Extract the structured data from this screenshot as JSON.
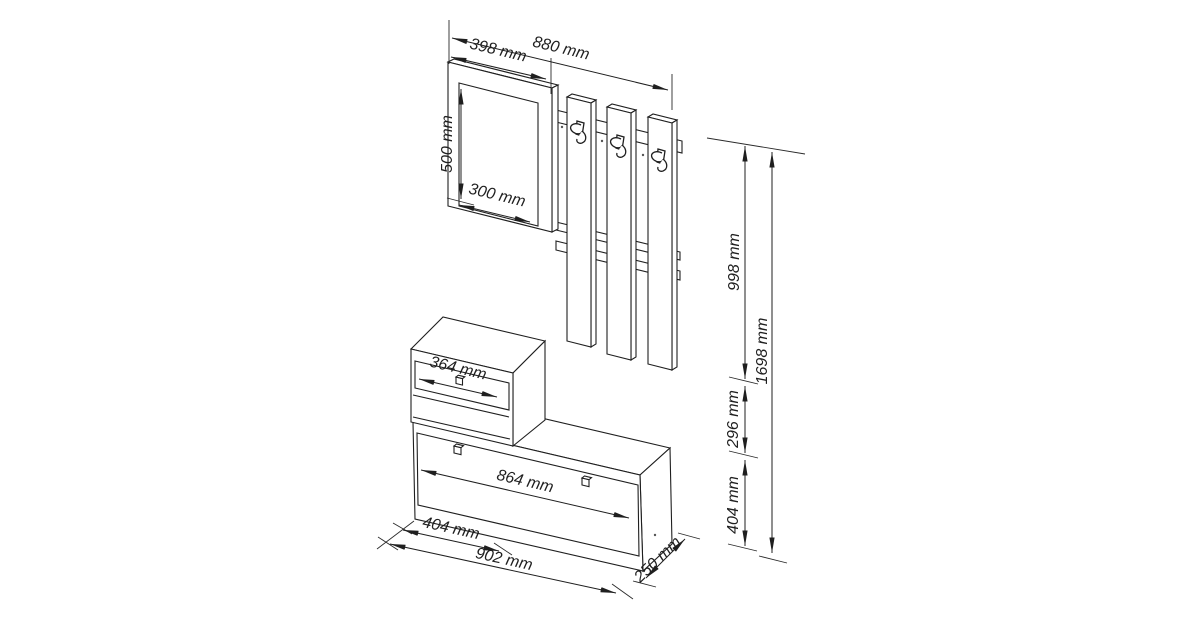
{
  "drawing": {
    "type": "furniture technical drawing",
    "subject": "hallway set: mirror, coat rack panels with hooks, drawer cabinet, shoe bench",
    "unit": "mm",
    "line_color": "#1f1f1f",
    "background": "#ffffff"
  },
  "labels": {
    "total_width": "880 mm",
    "mirror_width": "398 mm",
    "mirror_height": "500 mm",
    "mirror_glass_width": "300 mm",
    "rack_panel_height": "998 mm",
    "total_height": "1698 mm",
    "cabinet_section_height": "296 mm",
    "bench_section_height": "404 mm",
    "drawer_width": "364 mm",
    "bench_flap_width": "864 mm",
    "bench_left_section_width": "404 mm",
    "bench_total_width": "902 mm",
    "bench_depth": "250 mm"
  }
}
